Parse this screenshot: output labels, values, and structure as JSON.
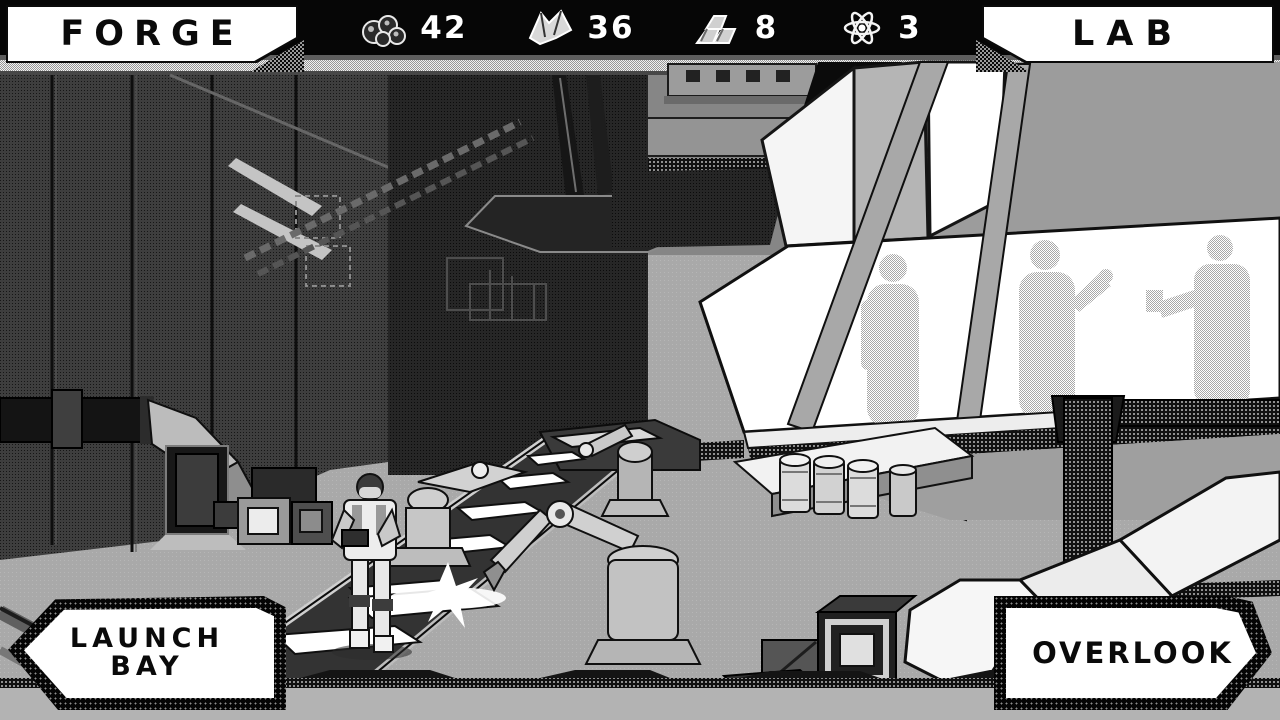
{
  "hud": {
    "forge_button": "FORGE",
    "lab_button": "LAB",
    "resources": [
      {
        "name": "ore",
        "icon": "ore-icon",
        "value": "42"
      },
      {
        "name": "crystal",
        "icon": "crystal-icon",
        "value": "36"
      },
      {
        "name": "ingot",
        "icon": "ingot-icon",
        "value": "8"
      },
      {
        "name": "atom",
        "icon": "atom-icon",
        "value": "3"
      }
    ]
  },
  "nav": {
    "launch_bay_line1": "LAUNCH",
    "launch_bay_line2": "BAY",
    "overlook_button": "OVERLOOK"
  },
  "scene": {
    "description": "monochrome dithered factory interior with conveyor, robot arms, engineer, observation window with three silhouettes"
  },
  "colors": {
    "hud_bg": "#060606",
    "hud_text": "#ffffff",
    "panel_bg": "#ffffff",
    "panel_text": "#0a0a0a",
    "floor": "#a9a9a9",
    "wall_dark": "#3e3e3e",
    "window_white": "#ffffff"
  }
}
